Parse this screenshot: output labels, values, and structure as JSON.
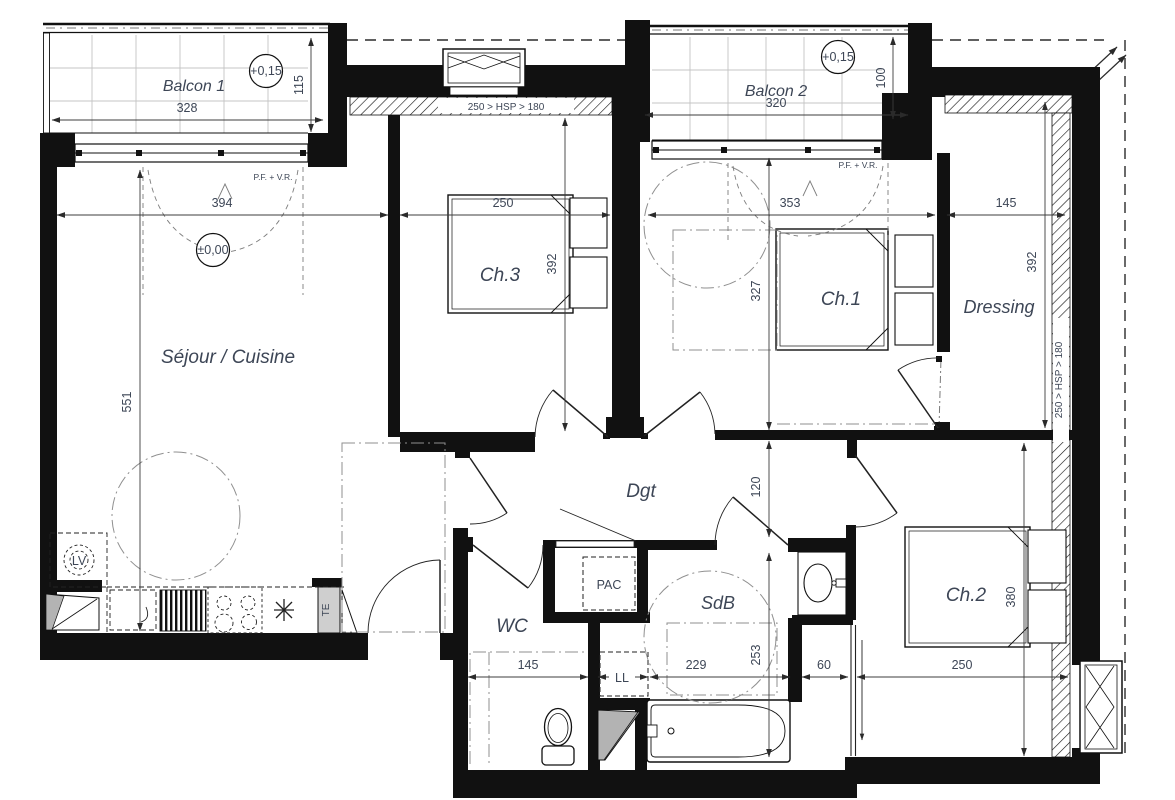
{
  "title": "Plan d'appartement 3 chambres",
  "rooms": {
    "balcon1": {
      "label": "Balcon 1",
      "level": "+0,15",
      "width": "328",
      "depth": "115"
    },
    "balcon2": {
      "label": "Balcon 2",
      "level": "+0,15",
      "width": "320",
      "depth": "100"
    },
    "sejour": {
      "label": "Séjour / Cuisine",
      "level": "±0,00",
      "width": "394",
      "depth": "551"
    },
    "ch3": {
      "label": "Ch.3",
      "width": "250",
      "depth": "392"
    },
    "ch1": {
      "label": "Ch.1",
      "width": "353",
      "depth": "327"
    },
    "dressing": {
      "label": "Dressing",
      "width": "145",
      "depth": "392"
    },
    "dgt": {
      "label": "Dgt",
      "width": "120"
    },
    "wc": {
      "label": "WC",
      "width": "145"
    },
    "sdb": {
      "label": "SdB",
      "width": "229",
      "depth": "253"
    },
    "ch2": {
      "label": "Ch.2",
      "width": "250",
      "depth": "380"
    },
    "passage": {
      "width": "60"
    }
  },
  "annotations": {
    "window_note": "P.F. + V.R.",
    "ceiling_note": "250 > HSP > 180",
    "heat_pump": "PAC",
    "dishwasher": "LV",
    "washing_machine": "LL",
    "electrical_board": "TE"
  }
}
